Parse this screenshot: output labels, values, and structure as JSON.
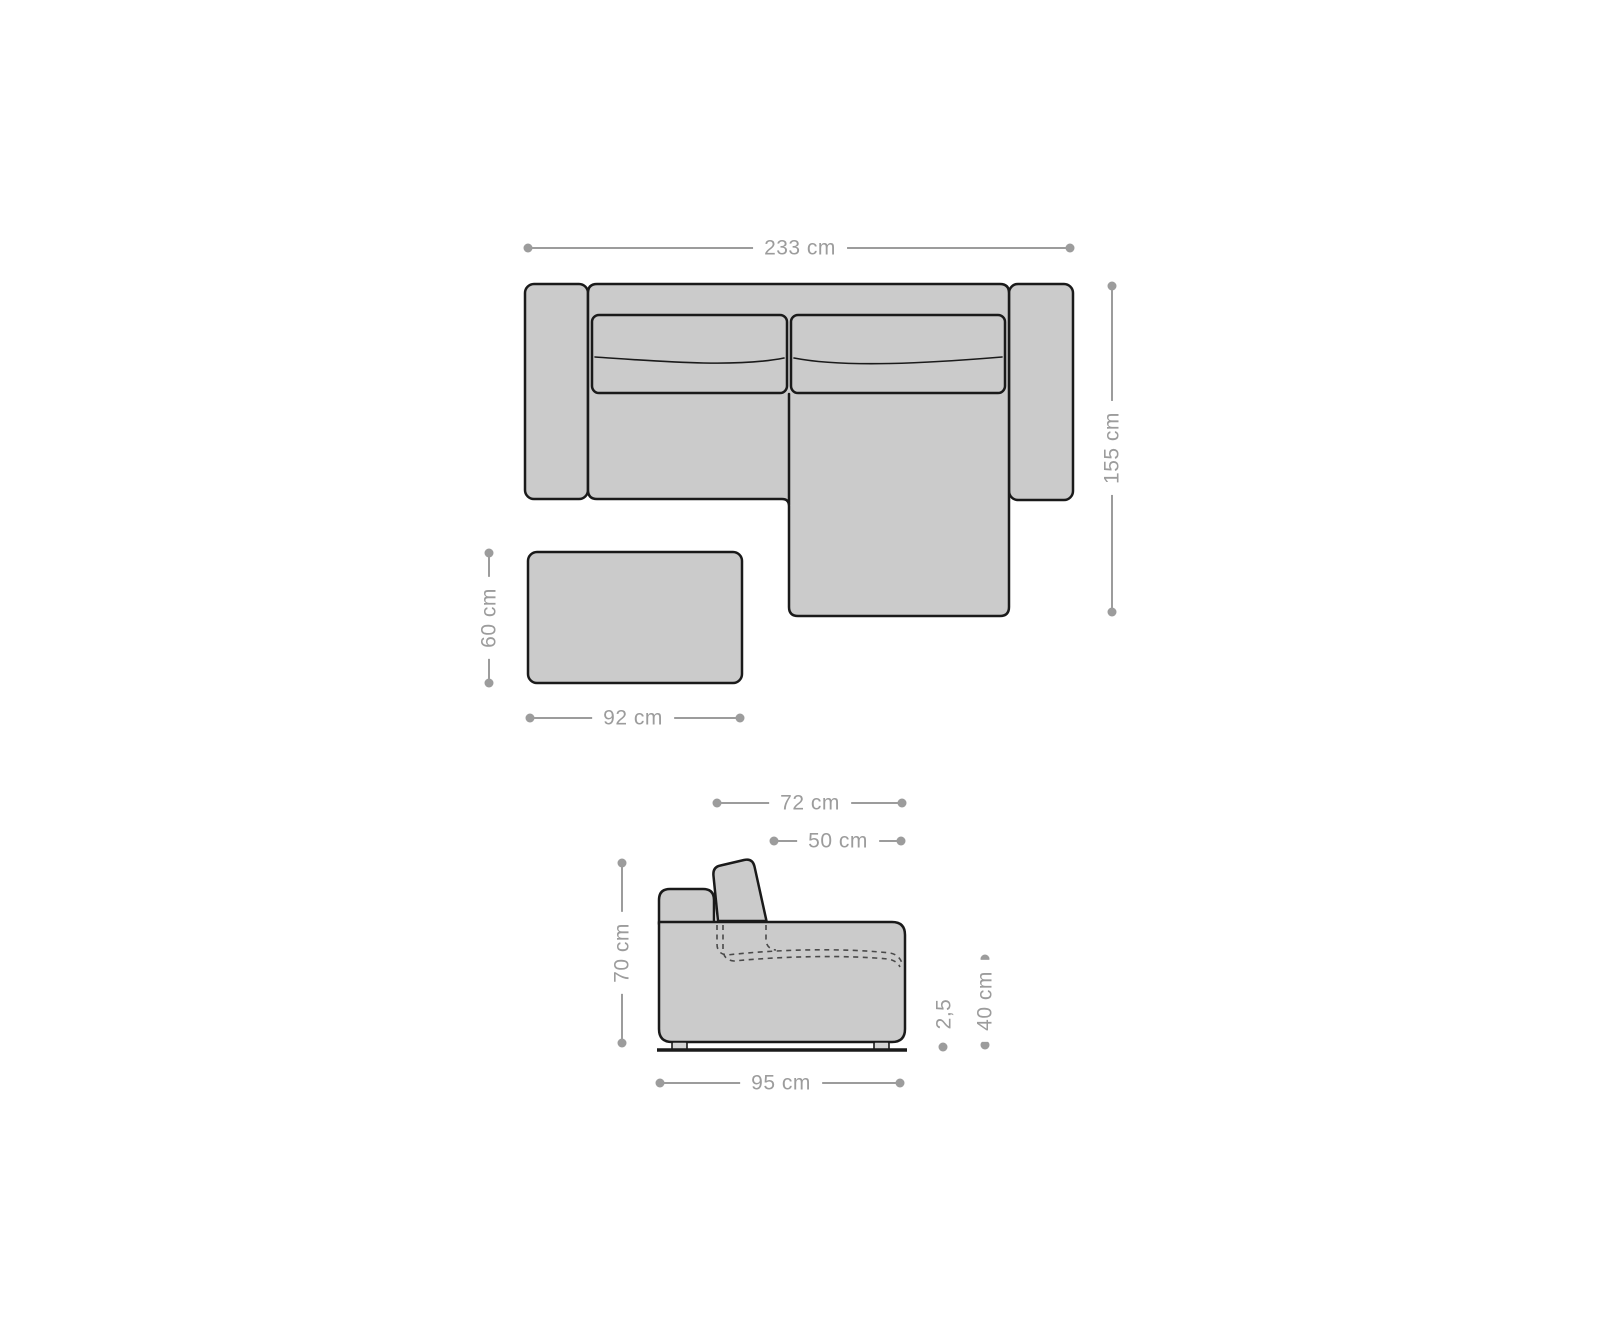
{
  "colors": {
    "background": "#ffffff",
    "shape_fill": "#cbcbcb",
    "foot_fill": "#d4d4d4",
    "shape_outline": "#1a1a1a",
    "dimension": "#9c9c9c",
    "hidden_edge": "#4a4a4a"
  },
  "top_view": {
    "sofa_width": "233 cm",
    "sofa_depth": "155 cm",
    "ottoman_width": "92 cm",
    "ottoman_depth": "60 cm"
  },
  "side_view": {
    "backrest_depth": "72 cm",
    "seat_depth": "50 cm",
    "total_height": "70 cm",
    "total_depth": "95 cm",
    "foot_height": "2,5",
    "seat_height": "40 cm"
  }
}
